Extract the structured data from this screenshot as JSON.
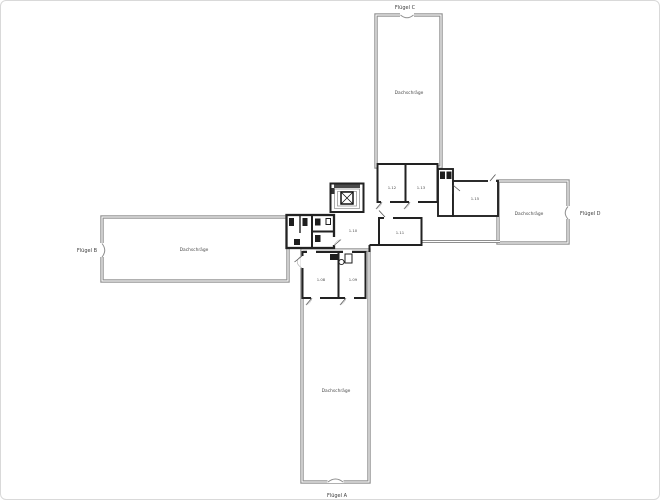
{
  "plan": {
    "title": "floor-plan",
    "wings": {
      "a": {
        "label": "Flügel A",
        "room": "Dachschräge"
      },
      "b": {
        "label": "Flügel B",
        "room": "Dachschräge"
      },
      "c": {
        "label": "Flügel C",
        "room": "Dachschräge"
      },
      "d": {
        "label": "Flügel D",
        "room": "Dachschräge"
      }
    },
    "core_rooms": {
      "top_left": "1.12",
      "top_right": "1.13",
      "right": "1.15",
      "center": "1.11",
      "lobby": "1.10",
      "lower_left": "1.08",
      "lower_right": "1.09"
    },
    "colors": {
      "background": "#ffffff",
      "wall_gray": "#8f8f8f",
      "wall_black": "#222222",
      "text": "#3c3c3c"
    }
  }
}
